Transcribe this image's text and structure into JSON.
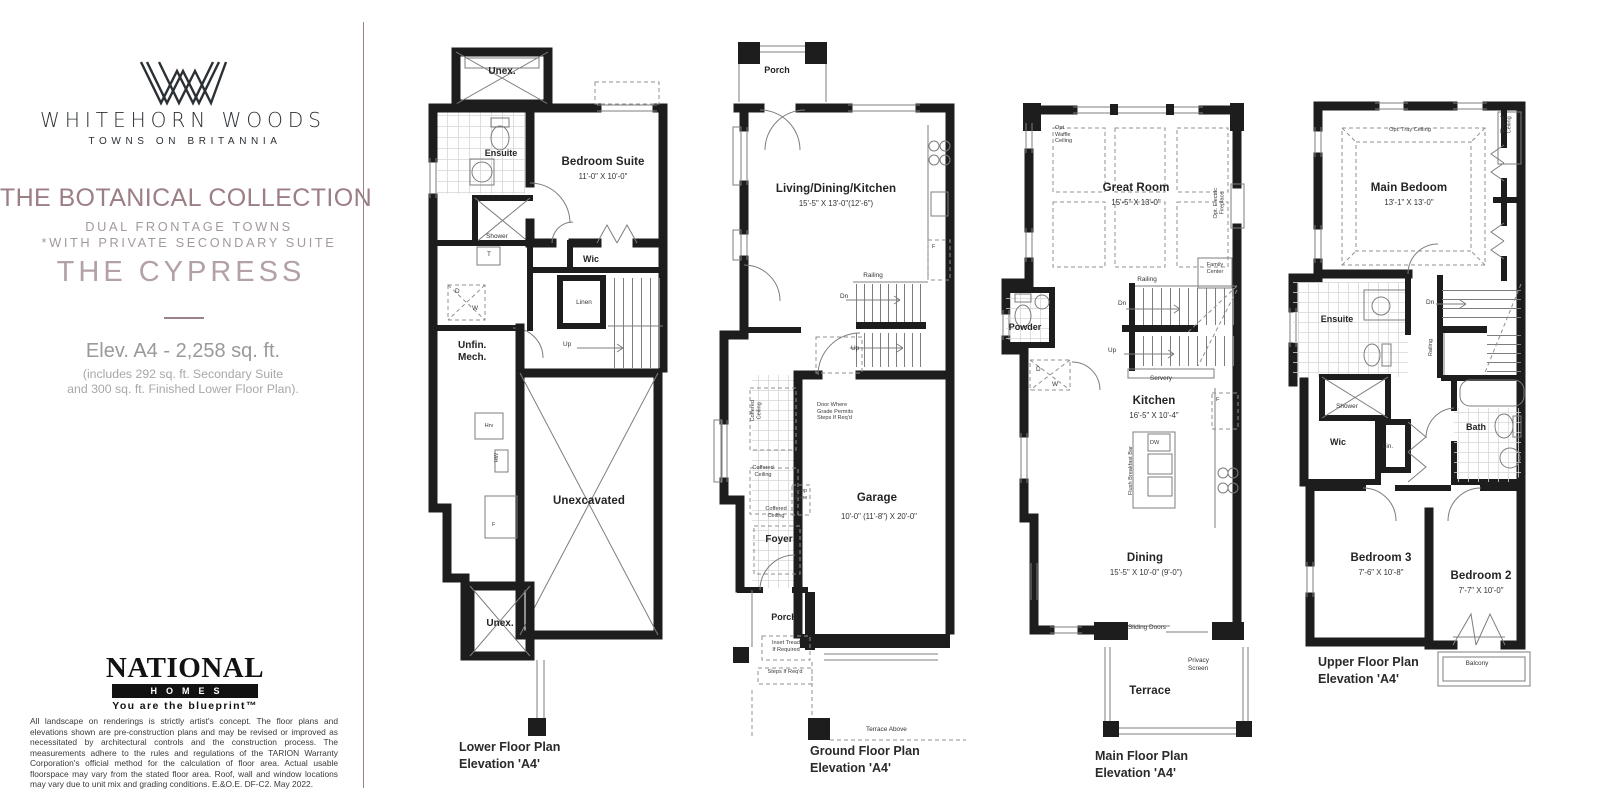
{
  "colors": {
    "accent": "#9c7e85",
    "accent_light": "#b2a1a5",
    "muted": "#a39a9c",
    "wall": "#1d1d1d"
  },
  "sidebar": {
    "brand": "WHITEHORN WOODS",
    "tagline": "TOWNS ON BRITANNIA",
    "collection_title": "THE BOTANICAL COLLECTION",
    "subtitle1": "DUAL FRONTAGE TOWNS",
    "subtitle2": "*WITH PRIVATE SECONDARY SUITE",
    "model_name": "THE CYPRESS",
    "elevation": "Elev. A4 - 2,258 sq. ft.",
    "elevation_note": "(includes 292 sq. ft. Secondary Suite\nand 300 sq. ft. Finished Lower Floor Plan).",
    "builder_name": "NATIONAL",
    "builder_sub": "HOMES",
    "builder_tagline": "You are the blueprint™",
    "disclaimer": "All landscape on renderings is strictly artist's concept. The floor plans and elevations shown are pre-construction plans and may be revised or improved as necessitated by architectural controls and the construction process. The measurements adhere to the rules and regulations of the TARION Warranty Corporation's official method for the calculation of floor area. Actual usable floorspace may vary from the stated floor area. Roof, wall and window locations may vary due to unit mix and grading conditions.  E.&O.E. DF-C2. May 2022."
  },
  "plans": {
    "lower": {
      "caption1": "Lower Floor Plan",
      "caption2": "Elevation 'A4'",
      "labels": {
        "unex_top": "Unex.",
        "ensuite": "Ensuite",
        "bedroom": "Bedroom Suite",
        "bedroom_dims": "11'-0\" X 10'-0\"",
        "shower": "Shower",
        "wic": "Wic",
        "linen": "Linen",
        "up": "Up",
        "t": "T",
        "d": "D",
        "w": "W",
        "unfin": "Unfin.\nMech.",
        "hrv": "Hrv",
        "hw": "HW",
        "f": "F",
        "unexcavated": "Unexcavated",
        "unex_bottom": "Unex."
      }
    },
    "ground": {
      "caption1": "Ground Floor Plan",
      "caption2": "Elevation 'A4'",
      "labels": {
        "porch_top": "Porch",
        "ldk": "Living/Dining/Kitchen",
        "ldk_dims": "15'-5\" X 13'-0\"(12'-6\")",
        "f": "F",
        "railing": "Railing",
        "dn": "Dn",
        "up": "Up",
        "coffered": "Coffered\nCeiling",
        "door_note": "Door Where\nGrade Permits\nSteps If Req'd",
        "drop_zone": "Drop\nZone",
        "foyer": "Foyer",
        "garage": "Garage",
        "garage_dims": "10'-0\" (11'-8\") X 20'-0\"",
        "porch_bottom": "Porch",
        "inset_tread": "Inset Tread\nIf Required",
        "steps": "Steps If Req'd",
        "terrace_above": "Terrace Above"
      }
    },
    "main": {
      "caption1": "Main Floor Plan",
      "caption2": "Elevation 'A4'",
      "labels": {
        "waffle": "Opt.\nWaffle\nCeiling",
        "great": "Great Room",
        "great_dims": "15'-5\" X 13'-0\"",
        "fireplace": "Opt. Electric\nFireplace",
        "family": "Family\nCenter",
        "railing": "Railing",
        "dn": "Dn",
        "up": "Up",
        "powder": "Powder",
        "d": "D",
        "w": "W",
        "servery": "Servery",
        "kitchen": "Kitchen",
        "kitchen_dims": "16'-5\" X 10'-4\"",
        "dw": "DW",
        "breakfast_bar": "Flush Breakfast Bar",
        "f": "F",
        "dining": "Dining",
        "dining_dims": "15'-5\" X 10'-0\" (9'-0\")",
        "sliding": "Sliding Doors",
        "privacy": "Privacy\nScreen",
        "terrace": "Terrace"
      }
    },
    "upper": {
      "caption1": "Upper Floor Plan",
      "caption2": "Elevation 'A4'",
      "labels": {
        "tray": "Opt. Tray Ceiling",
        "bedroom": "Main Bedoom",
        "bedroom_dims": "13'-1\" X 13'-0\"",
        "sloped": "Sloped\nCeiling",
        "ensuite": "Ensuite",
        "dn": "Dn",
        "railing": "Railing",
        "shower": "Shower",
        "wic": "Wic",
        "lin": "Lin.",
        "bath": "Bath",
        "bed3": "Bedroom 3",
        "bed3_dims": "7'-6\" X 10'-8\"",
        "bed2": "Bedroom 2",
        "bed2_dims": "7'-7\" X 10'-0\"",
        "balcony": "Balcony"
      }
    }
  }
}
